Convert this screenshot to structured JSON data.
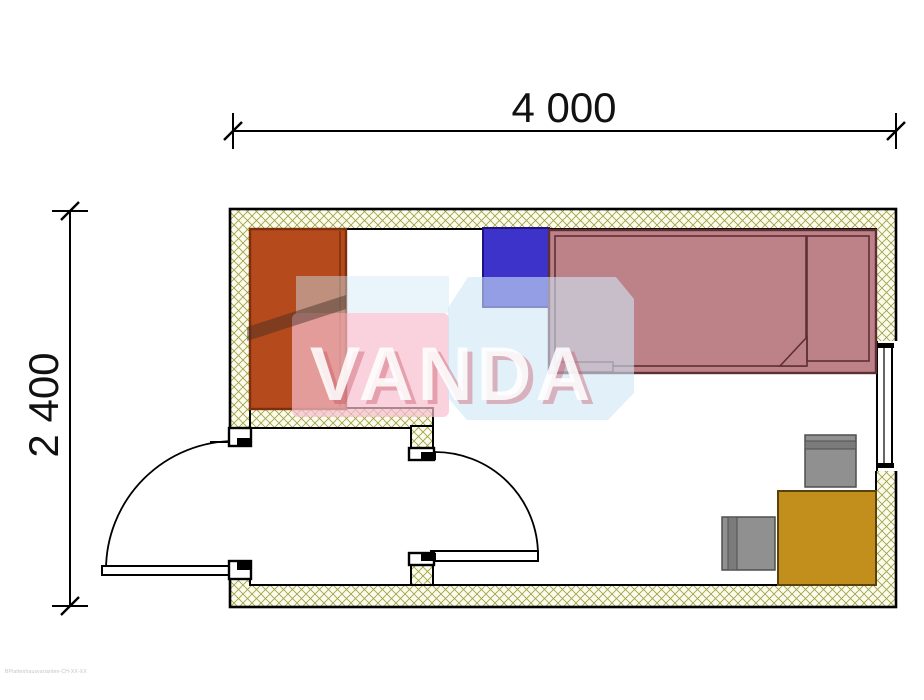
{
  "dimensions": {
    "width_label": "4 000",
    "height_label": "2 400"
  },
  "watermark": {
    "text": "VANDA"
  },
  "fineprint": "BPlattenhausvarianten-CH-XX-XX",
  "colors": {
    "wall_fill": "#fcfcee",
    "wall_hatch": "#a2a148",
    "outline": "#000000",
    "wardrobe": "#b54a1c",
    "wardrobe_outline": "#7c2f0b",
    "nightstand": "#3d33cb",
    "nightstand_outline": "#1c1282",
    "bed": "#bc8287",
    "bed_outline": "#5d2f35",
    "table": "#c28f1d",
    "table_outline": "#5a430a",
    "chair": "#909090",
    "chair_outline": "#4f4f4f",
    "chair_back": "#7b7b7b",
    "watermark_pink": "#f6bfcf",
    "watermark_blue": "#cfe6f6",
    "watermark_shadow": "#c84e62",
    "watermark_text": "#ffffff",
    "dimension_text": "#111111"
  }
}
